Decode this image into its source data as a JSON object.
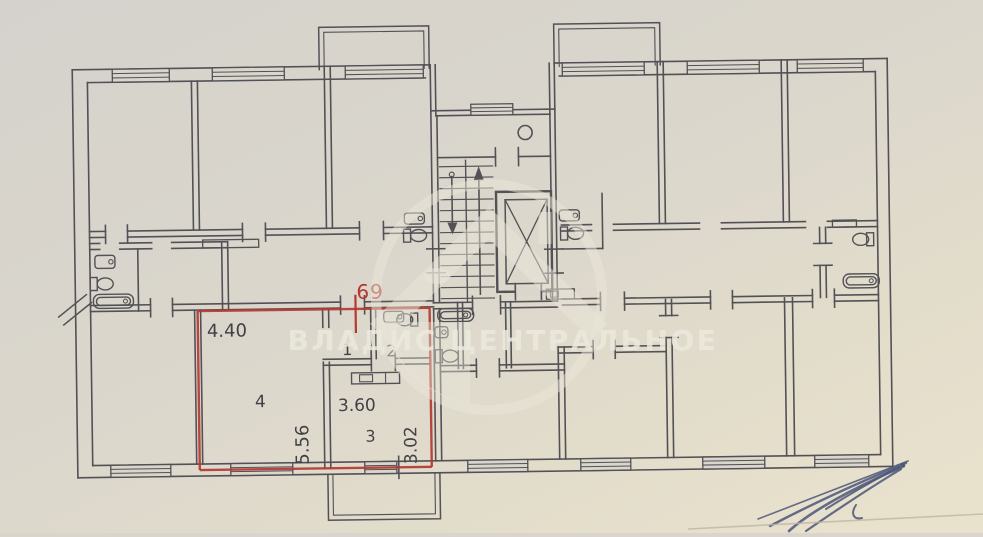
{
  "plan": {
    "unit_number": "69",
    "rooms": {
      "living": {
        "number": "4",
        "width": "4.40",
        "depth": "5.56"
      },
      "kitchen": {
        "number": "3",
        "width": "3.60",
        "depth": "3.02"
      },
      "hall": {
        "number": "1"
      },
      "bath": {
        "number": "2"
      }
    }
  },
  "watermark": {
    "text": "ВЛАДИС ЦЕНТРАЛЬНОЕ"
  },
  "colors": {
    "highlight": "#b2342b",
    "ink": "#4d4c51",
    "paper": "#dad6cc",
    "watermark": "#e9e6d8",
    "pen": "#4a5578"
  }
}
